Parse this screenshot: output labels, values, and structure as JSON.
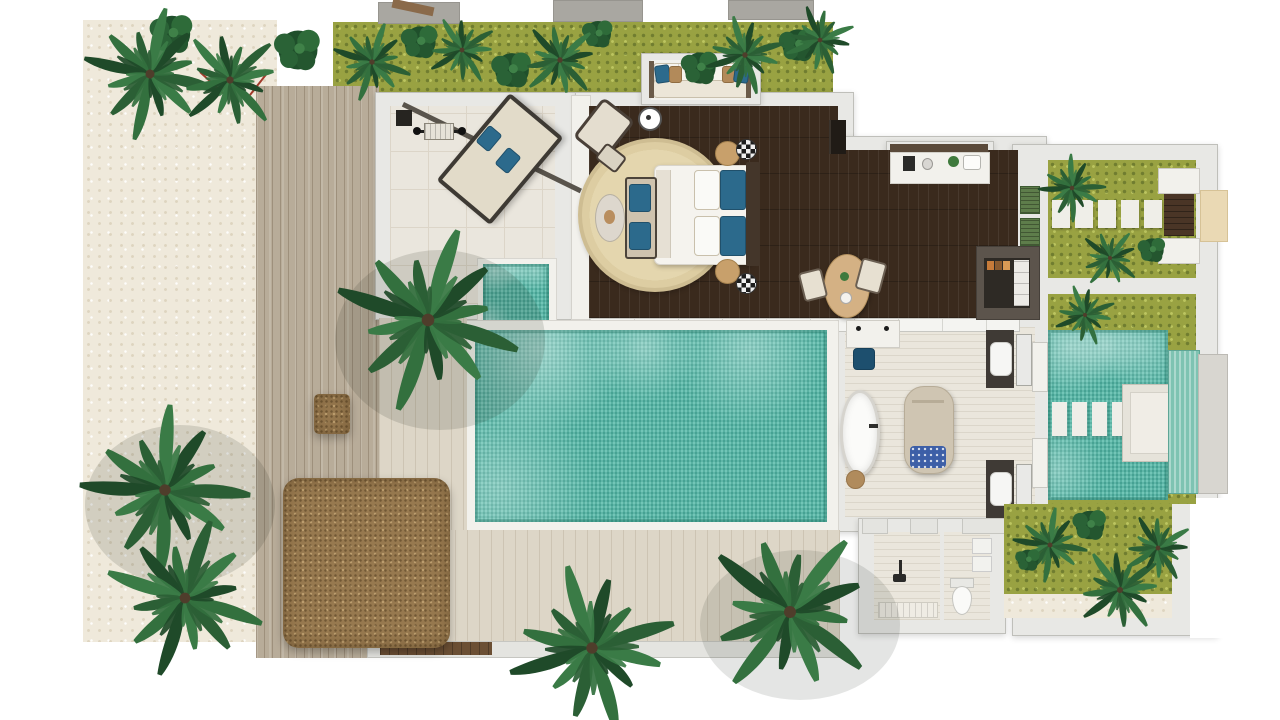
{
  "scene": {
    "type": "3d-floor-plan-top-view",
    "subject": "tropical-beach-pool-villa",
    "visible_text": "none"
  },
  "colors": {
    "bg": "#ffffff",
    "sand": "#efe9db",
    "deck-wood": "#b8ac99",
    "dark-wood-floor": "#3a2a1d",
    "pool-water": "#58bbaa",
    "wall": "#e8e8e5",
    "tile": "#eae6dd",
    "moss": "#99a242",
    "palm-green": "#2b5f35",
    "thatch-brown": "#97794f",
    "accent-pillow-blue": "#2c6a8c",
    "accent-pillow-tan": "#b28a5a",
    "tub-white": "#fbfbf9",
    "stone-pad": "#efeee8",
    "entry-step-tan": "#ead9b4"
  },
  "rooms": [
    {
      "name": "fitness-lounge"
    },
    {
      "name": "bedroom"
    },
    {
      "name": "living-dressing-area"
    },
    {
      "name": "bathroom"
    },
    {
      "name": "shower-room"
    },
    {
      "name": "wc"
    },
    {
      "name": "entry-courtyard"
    },
    {
      "name": "water-feature-courtyard"
    },
    {
      "name": "rear-garden"
    }
  ],
  "features": {
    "main_pool": 1,
    "plunge_pool_arm": 1,
    "entry_stepping_stones": 5,
    "water_court_stepping_stones": 4,
    "vanity_sinks": 2,
    "bathtub": 1,
    "massage_table": 1,
    "outdoor_sofa": 1,
    "king_bed": 1,
    "dining_table": 1,
    "thatched_pavilion": 1,
    "palm_clusters": 12
  }
}
